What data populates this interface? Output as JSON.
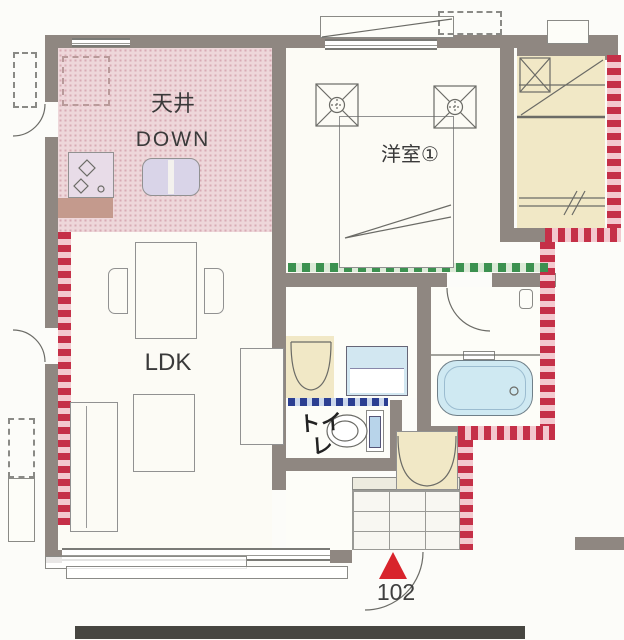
{
  "labels": {
    "kitchen_ceiling_note_1": "天井",
    "kitchen_ceiling_note_2": "DOWN",
    "western_room_1": "洋室①",
    "living_dining_kitchen": "LDK",
    "toilet": "トイレ",
    "unit_number": "102"
  },
  "colors": {
    "wall": "#8f8781",
    "kitchen_lowered_ceiling_fill": "#eed7da",
    "stair_and_storage_fill": "#f1e8c6",
    "bathtub_fill": "#cfe9f2",
    "exterior_hatch_red": "#c53048",
    "boundary_dotted_green": "#3c9150",
    "boundary_dotted_blue": "#2c3f92",
    "entrance_marker_red": "#d8242c"
  },
  "fixtures": [
    "stove",
    "kitchen-sink",
    "refrigerator-space",
    "dining-table",
    "chairs",
    "sofa",
    "coffee-table",
    "tv-board",
    "bed",
    "ceiling-fixtures",
    "staircase",
    "closet-folding-door",
    "washbasin",
    "toilet-bowl",
    "bathtub",
    "shoe-cabinet",
    "entrance-tile-floor"
  ],
  "marker": {
    "entrance_triangle": "▲",
    "unit_number": "102"
  }
}
